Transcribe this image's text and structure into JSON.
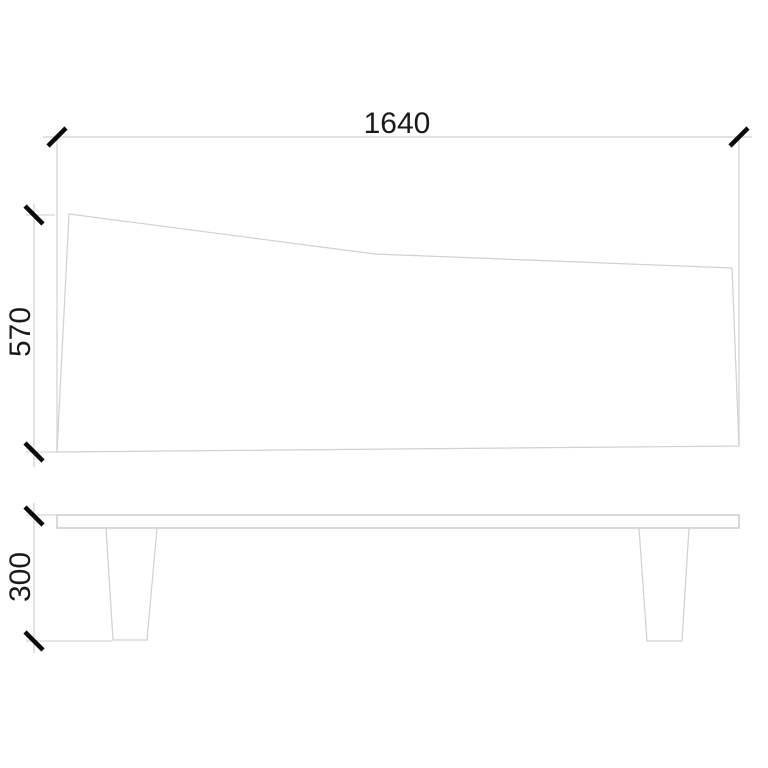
{
  "drawing": {
    "type": "furniture-technical-drawing",
    "dimensions": {
      "width": "1640",
      "depth": "570",
      "leg_height": "300"
    },
    "colors": {
      "background": "#ffffff",
      "geometry_line": "#d0d0d0",
      "dimension_line": "#dedede",
      "tick": "#0a0a0a",
      "text": "#1a1a1a"
    }
  }
}
